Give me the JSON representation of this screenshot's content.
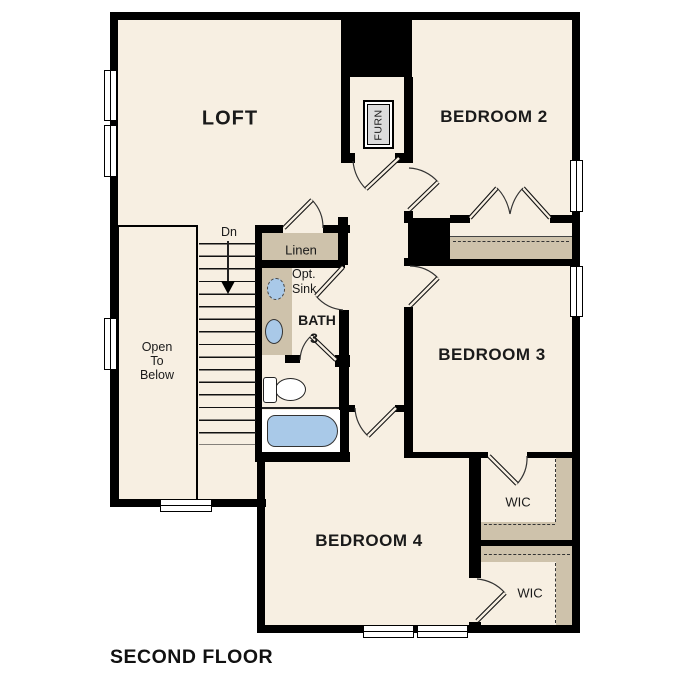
{
  "plan_title": "SECOND FLOOR",
  "rooms": {
    "loft": "LOFT",
    "bedroom2": "BEDROOM 2",
    "bedroom3": "BEDROOM 3",
    "bedroom4": "BEDROOM 4",
    "bath_line1": "BATH",
    "bath_line2": "3",
    "linen": "Linen",
    "furnace": "FURN",
    "wic_top": "WIC",
    "wic_bottom": "WIC"
  },
  "labels": {
    "opt_sink_line1": "Opt.",
    "opt_sink_line2": "Sink",
    "stairs_down": "Dn",
    "open_below_line1": "Open",
    "open_below_line2": "To",
    "open_below_line3": "Below"
  },
  "colors": {
    "floor": "#f7efe2",
    "shelf_tan": "#cec2ab",
    "fixture_blue": "#a9c9e8",
    "wall": "#000000",
    "furnace_fill": "#dcdcdc",
    "outside": "#ffffff"
  }
}
